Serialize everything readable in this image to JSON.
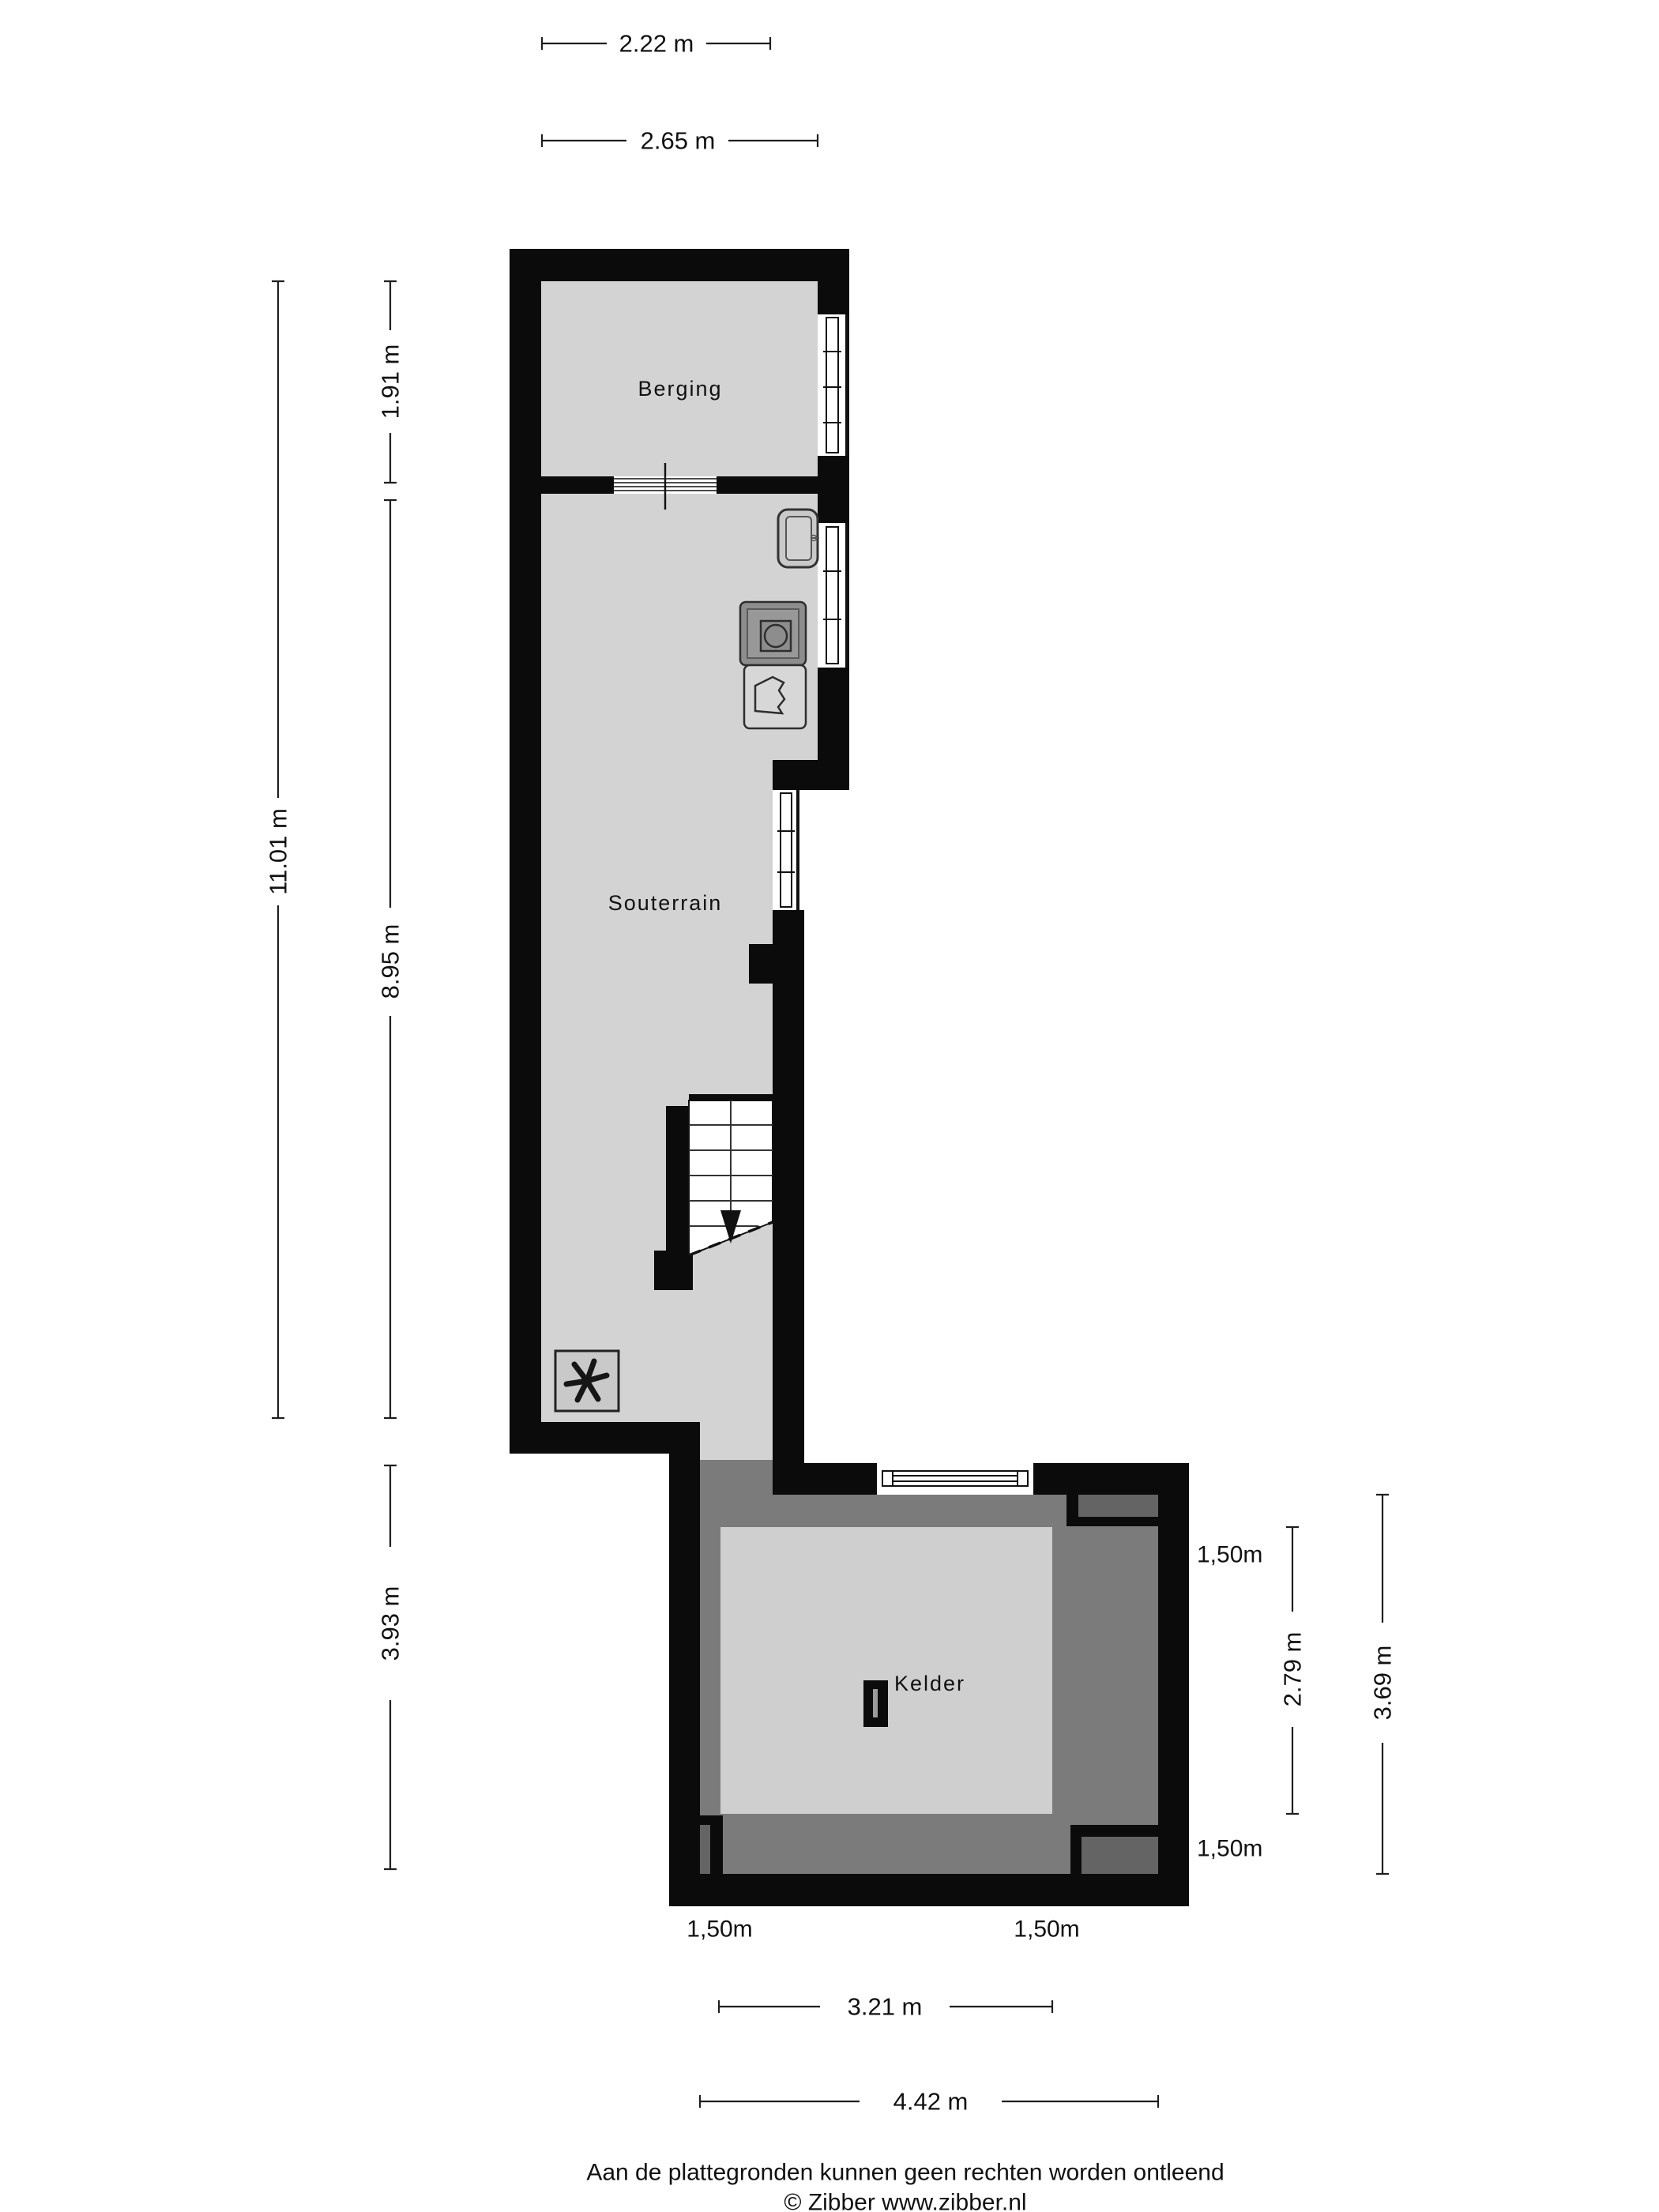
{
  "colors": {
    "wall": "#0b0b0b",
    "floor_light": "#d3d3d3",
    "floor_dark": "#7b7b7b",
    "inset_gray": "#646464",
    "dim_line": "#1f1f1f"
  },
  "rooms": {
    "berging": "Berging",
    "souterrain": "Souterrain",
    "kelder": "Kelder"
  },
  "dimensions": {
    "top": [
      {
        "label": "2.22 m"
      },
      {
        "label": "2.65 m"
      }
    ],
    "left": [
      {
        "label": "11.01 m"
      },
      {
        "label": "1.91 m"
      },
      {
        "label": "8.95 m"
      },
      {
        "label": "3.93 m"
      }
    ],
    "right": [
      {
        "label": "2.79 m"
      },
      {
        "label": "3.69 m"
      }
    ],
    "bottom": [
      {
        "label": "3.21 m"
      },
      {
        "label": "4.42 m"
      }
    ],
    "height_marker": "1,50m"
  },
  "footer": {
    "disclaimer": "Aan de plattegronden kunnen geen rechten worden ontleend",
    "copyright": "© Zibber www.zibber.nl"
  }
}
